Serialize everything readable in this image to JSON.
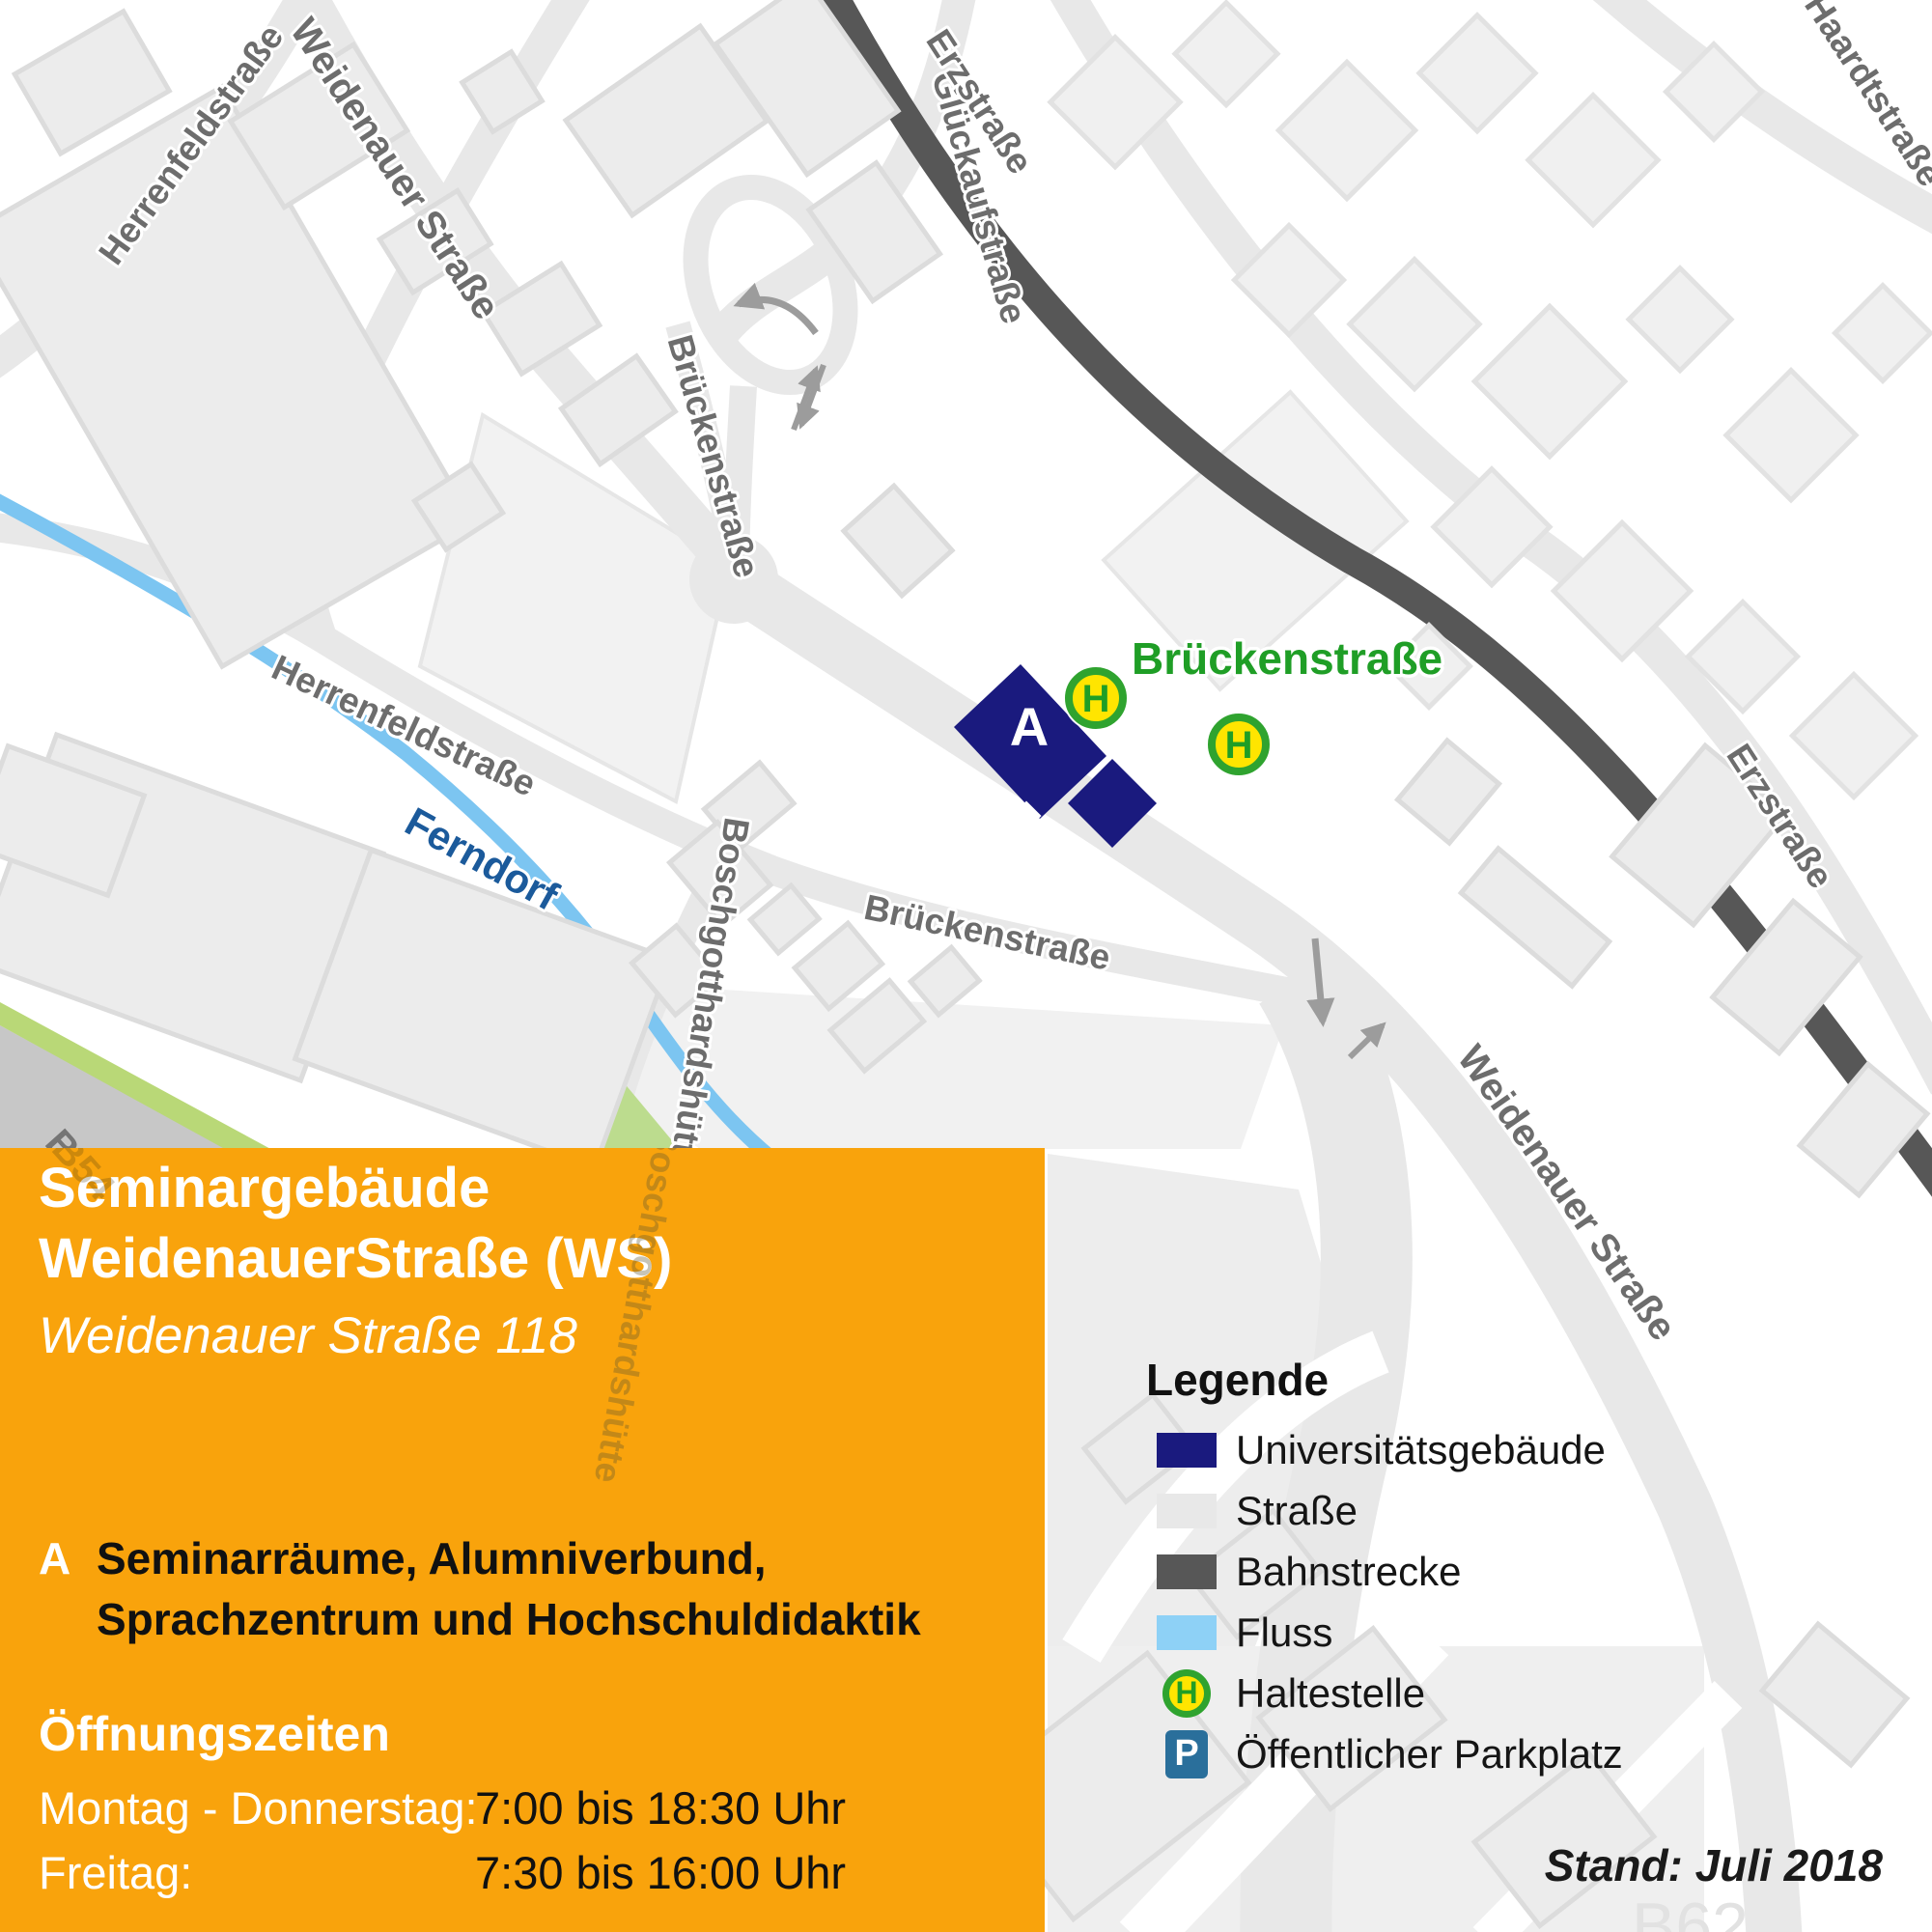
{
  "map": {
    "street_labels": [
      {
        "text": "Herrenfeldstraße"
      },
      {
        "text": "Weidenauer Straße"
      },
      {
        "text": "Glückaufstraße"
      },
      {
        "text": "Erzstraße"
      },
      {
        "text": "Haardtstraße"
      },
      {
        "text": "Brückenstraße"
      },
      {
        "text": "Herrenfeldstraße"
      },
      {
        "text": "Boschgotthardshütte"
      },
      {
        "text": "Brückenstraße"
      },
      {
        "text": "Erzstraße"
      },
      {
        "text": "Weidenauer Straße"
      },
      {
        "text": "Boschgotthardshütte"
      }
    ],
    "river_label": "Ferndorf",
    "road_b54": "B54",
    "road_b62": "B62",
    "bus_stop_street_label": "Brückenstraße",
    "building_marker": "A",
    "haltestelle_letter": "H"
  },
  "panel": {
    "title_line1": "Seminargebäude",
    "title_line2": "WeidenauerStraße (WS)",
    "address": "Weidenauer Straße 118",
    "marker": "A",
    "description_line1": "Seminarräume, Alumniverbund,",
    "description_line2": "Sprachzentrum und Hochschuldidaktik",
    "hours_heading": "Öffnungszeiten",
    "hours": [
      {
        "label": "Montag - Donnerstag:",
        "time": "7:00 bis 18:30 Uhr"
      },
      {
        "label": "Freitag:",
        "time": "7:30 bis 16:00 Uhr"
      }
    ]
  },
  "legend": {
    "title": "Legende",
    "items": [
      {
        "label": "Universitätsgebäude"
      },
      {
        "label": "Straße"
      },
      {
        "label": "Bahnstrecke"
      },
      {
        "label": "Fluss"
      },
      {
        "label": "Haltestelle"
      },
      {
        "label": "Öffentlicher Parkplatz"
      }
    ],
    "h_letter": "H",
    "p_letter": "P"
  },
  "footer": {
    "stand": "Stand: Juli 2018"
  },
  "colors": {
    "panel_orange": "#f9a30c",
    "university_navy": "#1a1a7e",
    "street_gray": "#e8e8e8",
    "rail_gray": "#575757",
    "river_blue": "#7cc5f1",
    "legend_river_blue": "#8ed1f6",
    "bus_stop_green": "#2fa32f",
    "bus_stop_yellow": "#ffe500",
    "green_label": "#1f9e26",
    "parking_blue": "#2a6f9b",
    "greenery": "#b9d877",
    "b54_band_gray": "#c7c7c7"
  }
}
